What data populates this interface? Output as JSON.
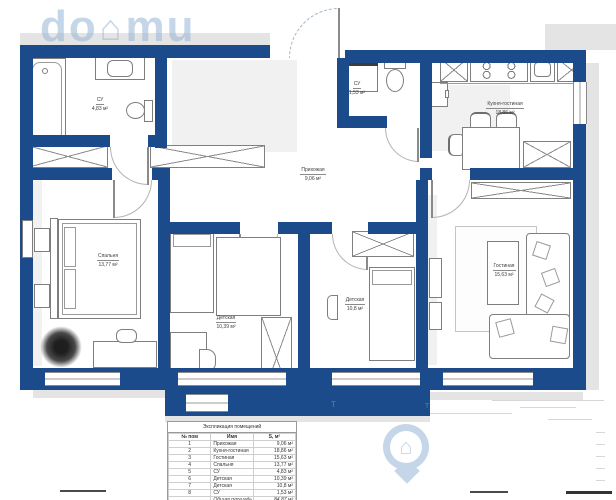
{
  "meta": {
    "type": "apartment-floor-plan",
    "language": "ru"
  },
  "watermark": {
    "prefix": "do",
    "suffix": "mu",
    "house_glyph": "⌂"
  },
  "markers": {
    "section_label": "Т"
  },
  "rooms": [
    {
      "id": "bathroom",
      "label": "СУ",
      "area": "4,83 м²"
    },
    {
      "id": "wc",
      "label": "СУ",
      "area": "1,53 м²"
    },
    {
      "id": "hallway",
      "label": "Прихожая",
      "area": "9,06 м²"
    },
    {
      "id": "kitchen",
      "label": "Кухня-гостиная",
      "area": "18,86 м²"
    },
    {
      "id": "bedroom",
      "label": "Спальня",
      "area": "13,77 м²"
    },
    {
      "id": "kids1",
      "label": "Детская",
      "area": "10,39 м²"
    },
    {
      "id": "kids2",
      "label": "Детская",
      "area": "10,8 м²"
    },
    {
      "id": "living",
      "label": "Гостиная",
      "area": "15,63 м²"
    }
  ],
  "legend_table": {
    "title": "Экспликация помещений",
    "columns": [
      "№ пом",
      "Имя",
      "S, м²"
    ],
    "rows": [
      [
        "1",
        "Прихожая",
        "9,06 м²"
      ],
      [
        "2",
        "Кухня-гостиная",
        "18,86 м²"
      ],
      [
        "3",
        "Гостиная",
        "15,63 м²"
      ],
      [
        "4",
        "Спальня",
        "13,77 м²"
      ],
      [
        "5",
        "СУ",
        "4,83 м²"
      ],
      [
        "6",
        "Детская",
        "10,39 м²"
      ],
      [
        "7",
        "Детская",
        "10,8 м²"
      ],
      [
        "8",
        "СУ",
        "1,53 м²"
      ]
    ],
    "total_label": "Общая площадь",
    "total_value": "84,87 м²"
  },
  "colors": {
    "wall": "#1c4b8c",
    "shadow": "#e4e4e4",
    "furniture_line": "#7e7e7e",
    "watermark": "rgba(150,180,214,0.55)"
  }
}
